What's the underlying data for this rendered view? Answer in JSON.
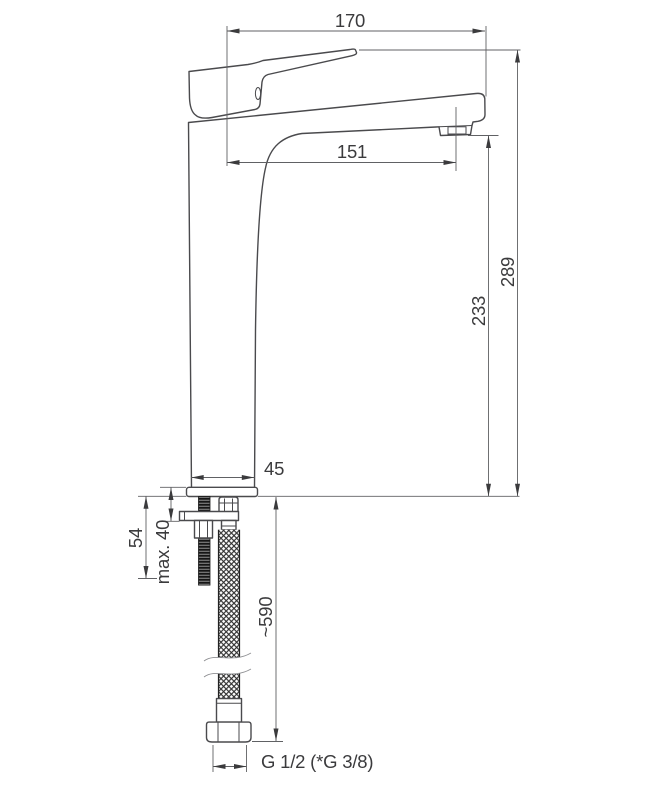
{
  "drawing": {
    "type": "technical-dimension-drawing",
    "subject": "tall single-lever basin mixer faucet with flexible supply hose"
  },
  "colors": {
    "line": "#4a4a4d",
    "dim": "#606164",
    "text": "#3b3b3d",
    "bg": "#ffffff",
    "stud": "#161616",
    "braid": "#2e2e2e"
  },
  "dimensions": {
    "overall_width": "170",
    "spout_reach": "151",
    "overall_height": "289",
    "spout_height": "233",
    "body_diameter": "45",
    "stud_length": "54",
    "max_mounting_thickness": "max. 40",
    "hose_length": "~590",
    "thread_size": "G 1/2 (*G 3/8)"
  }
}
